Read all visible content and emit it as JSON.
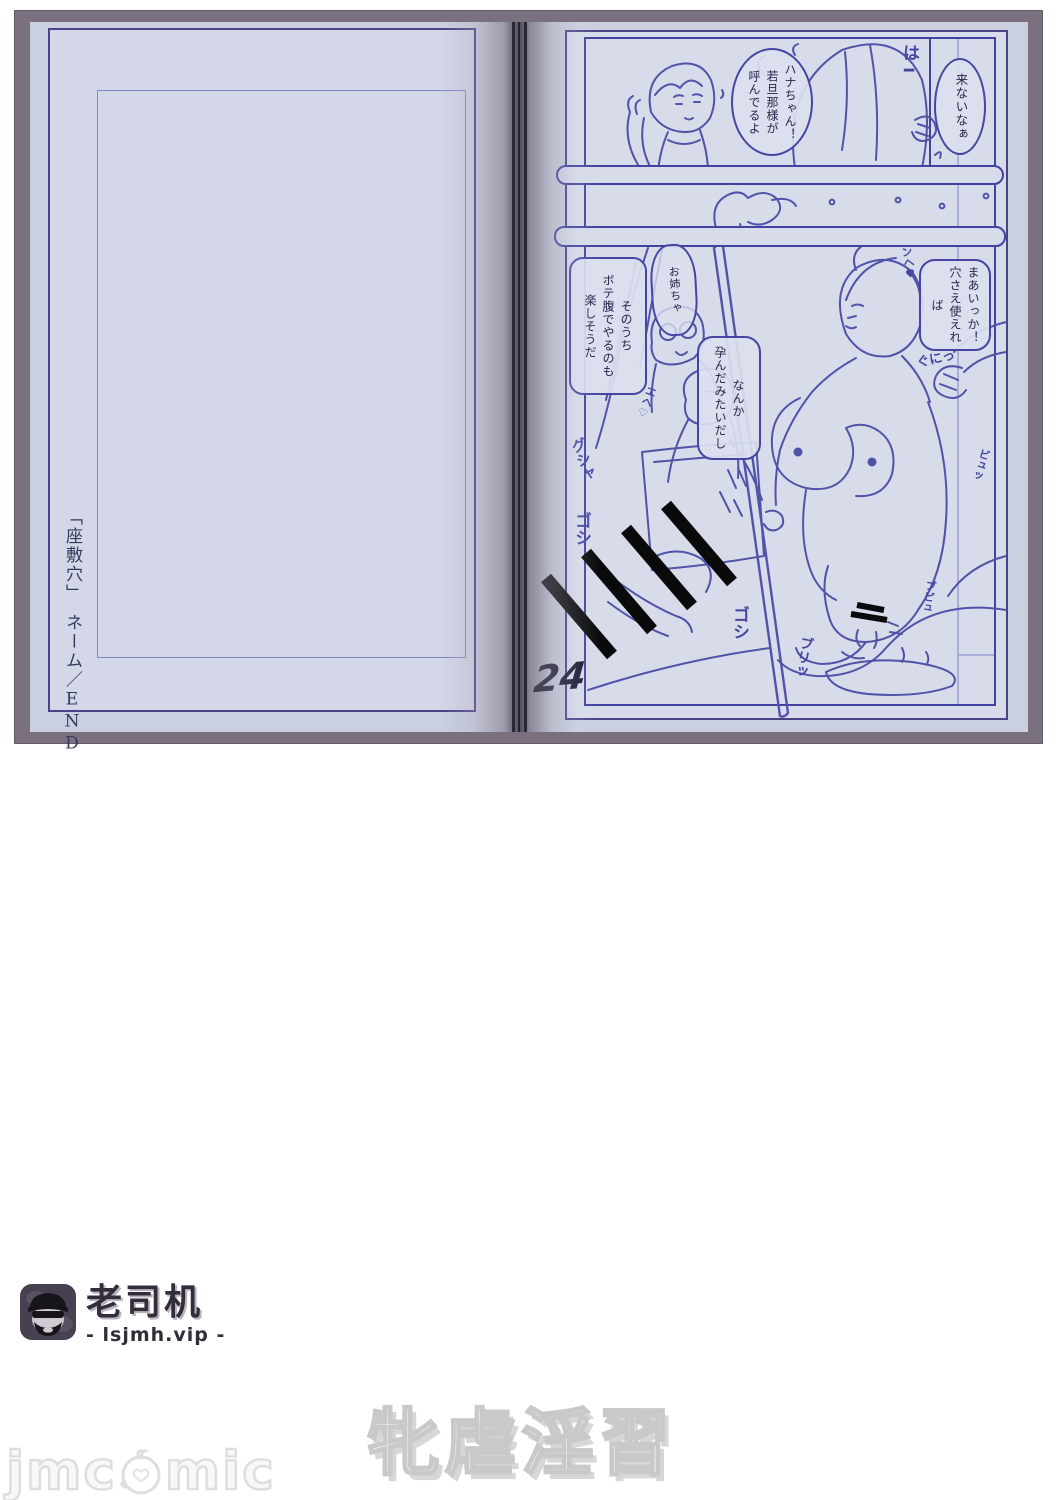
{
  "scan": {
    "left_page": {
      "vertical_title": "「座敷穴」　ネーム／END"
    },
    "right_page": {
      "page_number": "24",
      "bubbles": {
        "konai": "来ないなぁ",
        "hana": "ハナちゃん！\n若旦那様が\n呼んでるよ",
        "maa": "まあいっか！\n穴さえ使えれば",
        "nanka": "なんか\n孕んだみたいだし",
        "sonouchi": "そのうち\nボテ腹でやるのも\n楽しそうだ",
        "onee": "お姉ちゃ"
      },
      "sfx": {
        "haa": "は━",
        "gusha": "グシャ",
        "goshi1": "ゴシ",
        "goshi2": "ゴシ",
        "buri": "ブリッ",
        "guni": "ぐにっ",
        "ehe": "エヘ♡",
        "nhe": "ンヘ♥",
        "byu": "ビュッ",
        "bupyu": "ブピュ"
      }
    }
  },
  "watermarks": {
    "logo_title": "老司机",
    "logo_sub": "- lsjmh.vip -",
    "series_title": "牝虐淫習",
    "corner_left": "jmc",
    "corner_right": "mic"
  },
  "colors": {
    "ink_blue": "#5053a8",
    "frame_purple": "#4b4186",
    "paper_blue": "#d7dbea",
    "censor_black": "#0a0a0a"
  }
}
